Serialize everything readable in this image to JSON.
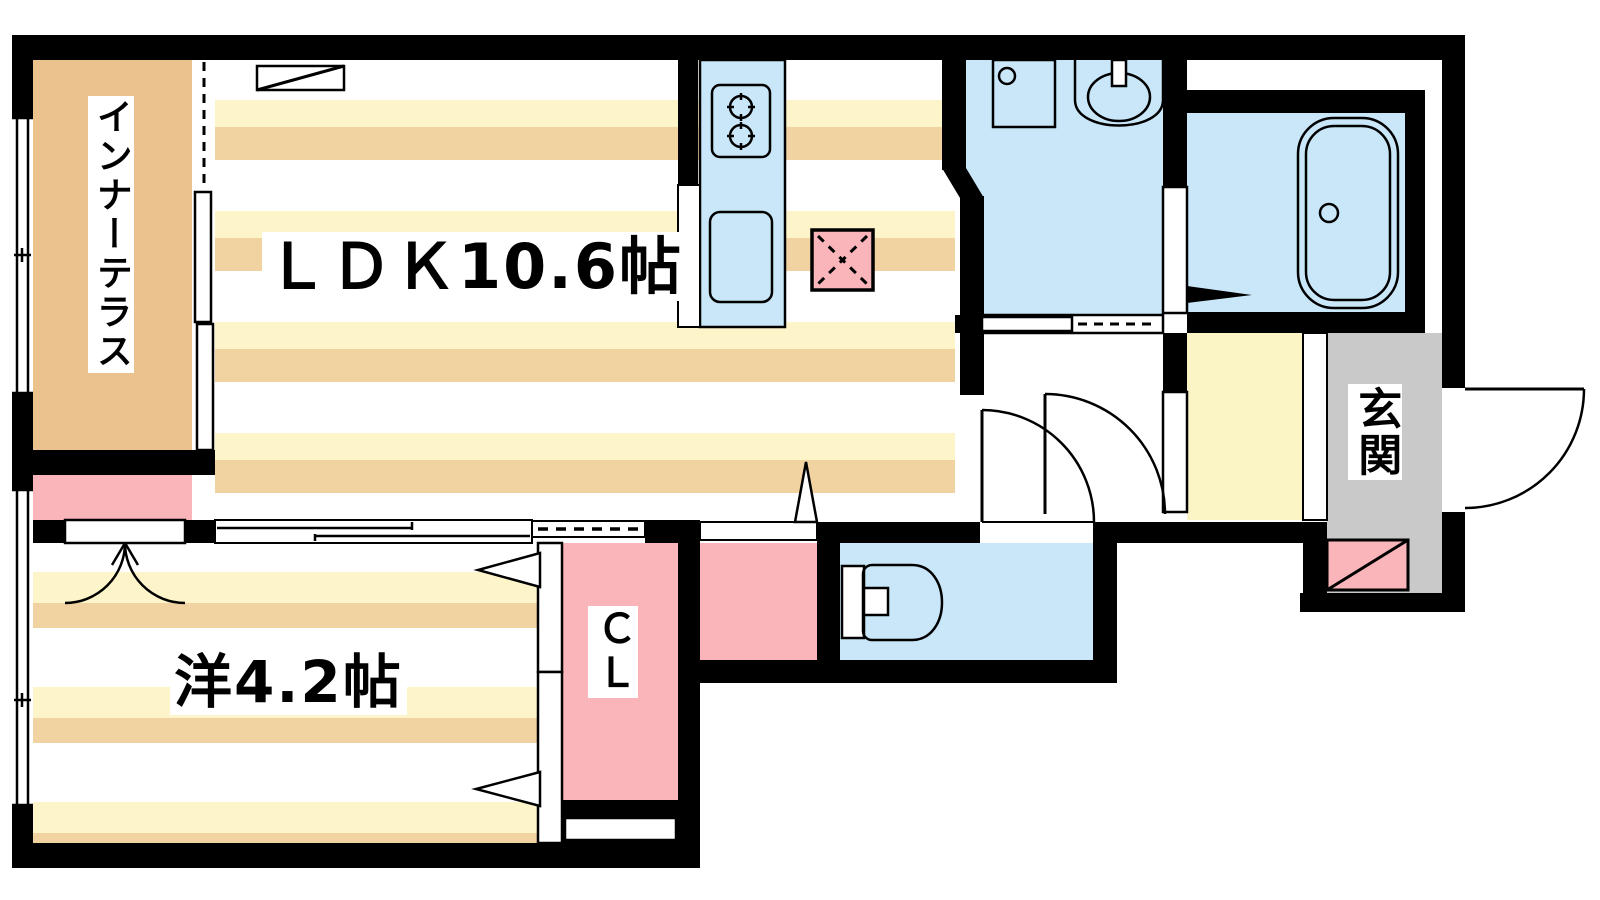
{
  "plan_title": "1LDK apartment floor plan",
  "rooms": {
    "ldk": {
      "label": "ＬＤＫ10.6帖"
    },
    "bedroom": {
      "label": "洋4.2帖"
    },
    "terrace": {
      "label": "インナーテラス"
    },
    "closet": {
      "label": "ＣＬ"
    },
    "entrance": {
      "label": "玄関"
    }
  },
  "colors": {
    "wall": "#000000",
    "floor_stripe_yellow": "#fdf5c9",
    "floor_stripe_tan": "#f1d3a1",
    "terrace_tan": "#ebc28e",
    "water_blue": "#c9e7f9",
    "accent_pink": "#f9b5b9",
    "entrance_gray": "#c9c9c9",
    "hall_yellow": "#fbf5c5"
  }
}
